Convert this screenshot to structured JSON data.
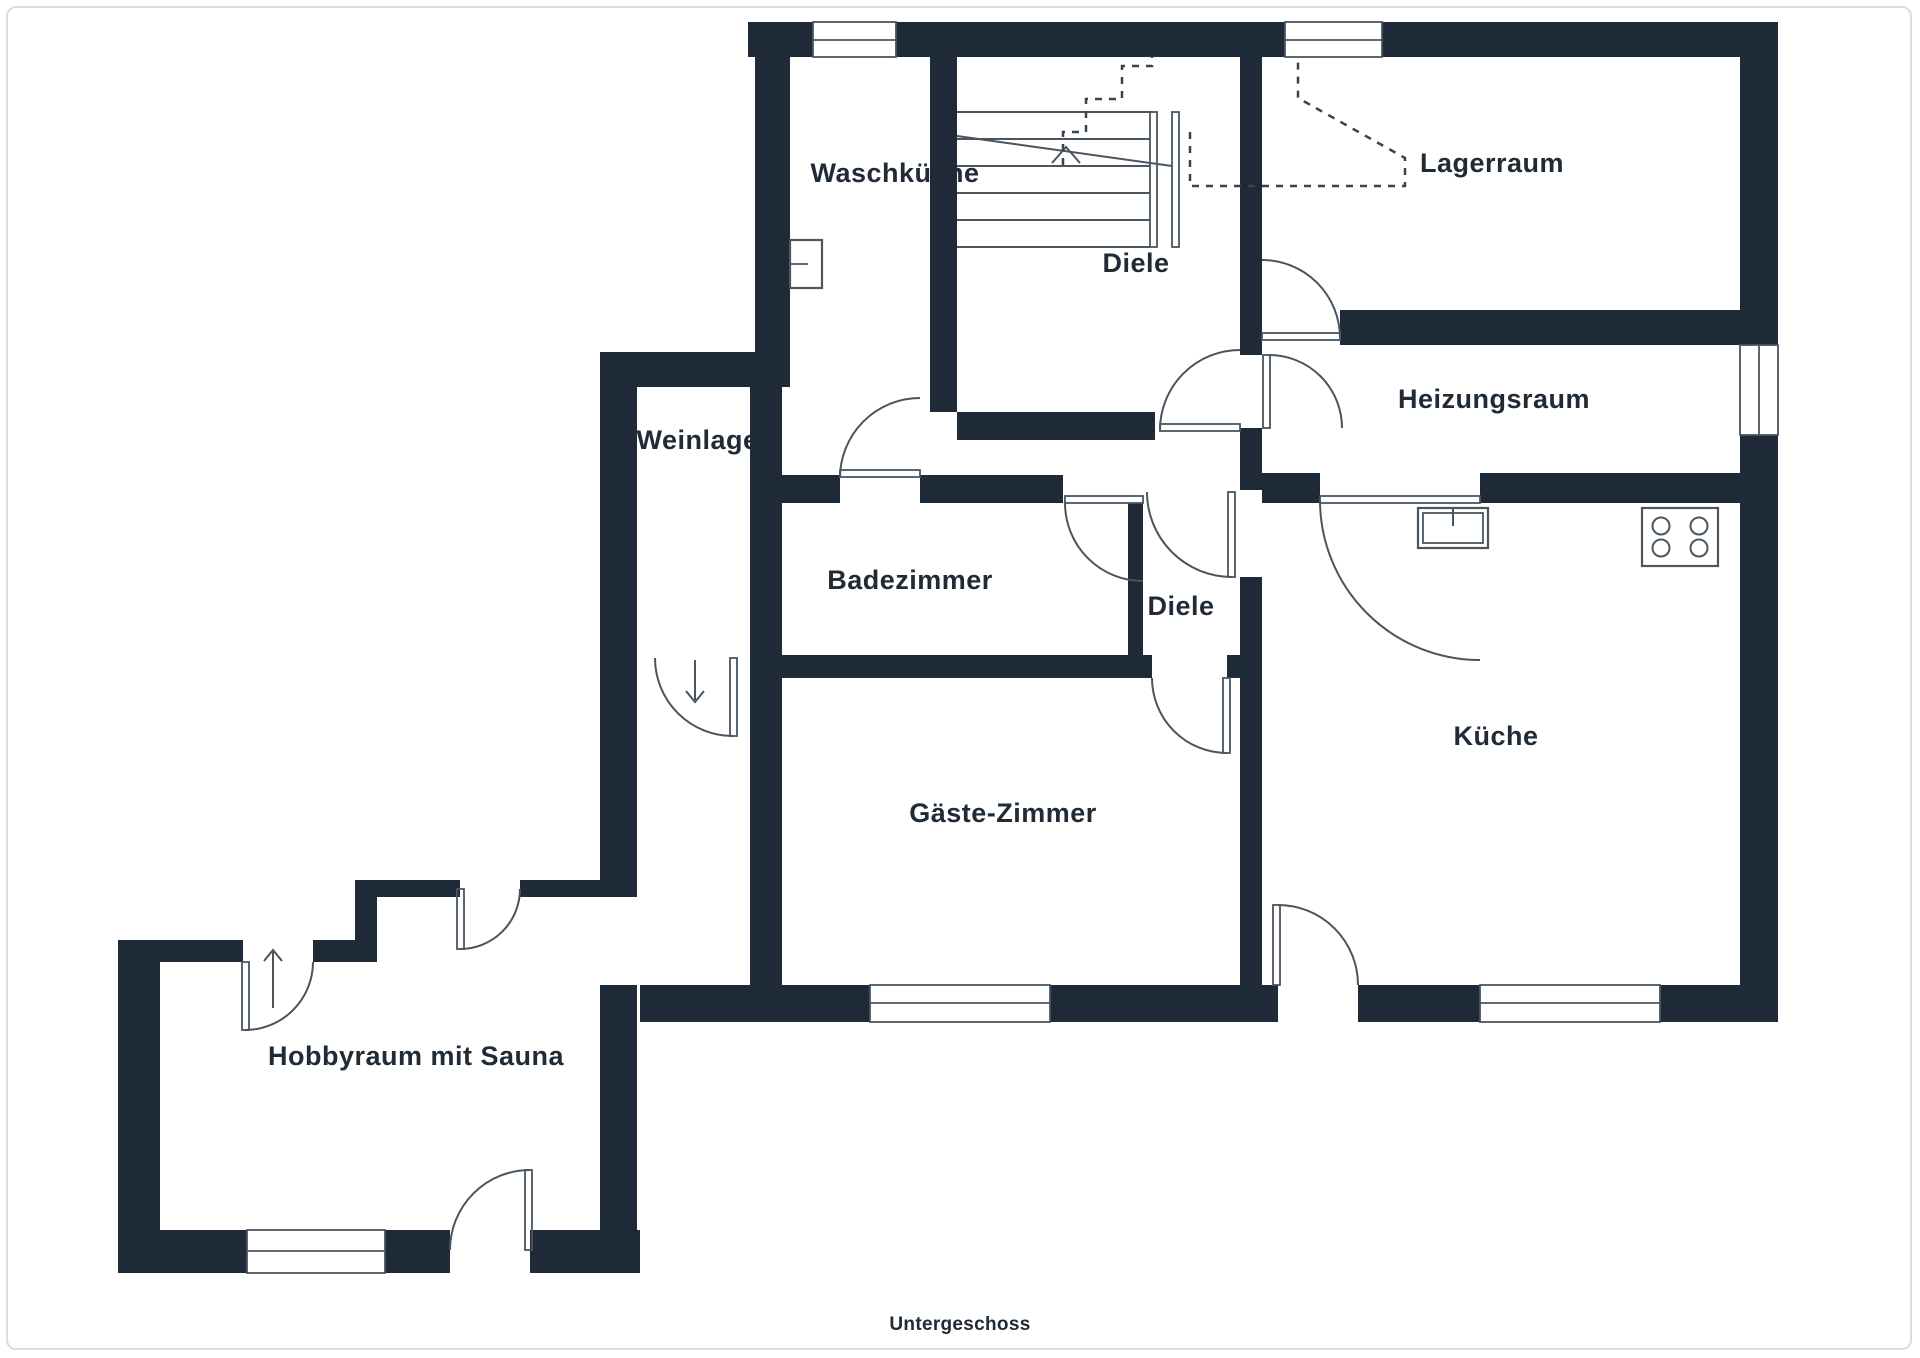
{
  "plan": {
    "caption": "Untergeschoss",
    "rooms": [
      {
        "id": "waschkueche",
        "label": "Waschküche"
      },
      {
        "id": "diele-upper",
        "label": "Diele"
      },
      {
        "id": "lagerraum",
        "label": "Lagerraum"
      },
      {
        "id": "heizungsraum",
        "label": "Heizungsraum"
      },
      {
        "id": "weinlager",
        "label": "Weinlager"
      },
      {
        "id": "badezimmer",
        "label": "Badezimmer"
      },
      {
        "id": "diele-lower",
        "label": "Diele"
      },
      {
        "id": "kueche",
        "label": "Küche"
      },
      {
        "id": "gaeste-zimmer",
        "label": "Gäste-Zimmer"
      },
      {
        "id": "hobbyraum",
        "label": "Hobbyraum mit Sauna"
      }
    ],
    "icons": [
      "stairs-icon",
      "kitchen-sink-icon",
      "stove-icon",
      "laundry-sink-icon",
      "entrance-arrow-up-icon",
      "entrance-arrow-down-icon"
    ]
  },
  "colors": {
    "wall": "#1E2A37",
    "line": "#4A5560",
    "text": "#212B36",
    "frame": "#D9DDE2",
    "bg": "#FFFFFF"
  }
}
